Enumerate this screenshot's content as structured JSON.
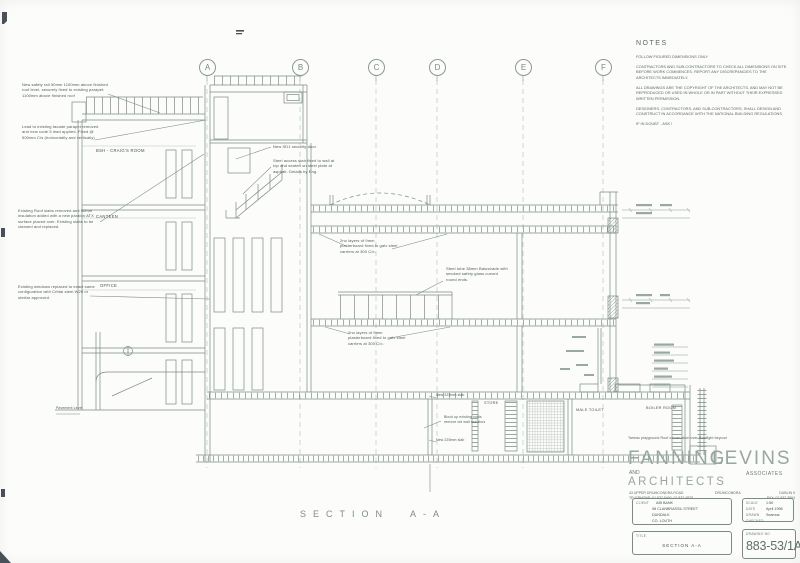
{
  "sheet": {
    "background": "#fcfcfa",
    "line_color": "#7b8b85",
    "text_color": "#4e5e58",
    "accent_light": "#98a7a1"
  },
  "grid": {
    "a": "A",
    "b": "B",
    "c": "C",
    "d": "D",
    "e": "E",
    "f": "F"
  },
  "notes": {
    "heading": "NOTES",
    "para1": "FOLLOW FIGURED DIMENSIONS ONLY",
    "para2": "CONTRACTORS AND SUB-CONTRACTORS TO CHECK ALL DIMENSIONS ON SITE BEFORE WORK COMMENCES. REPORT ANY DISCREPANCIES TO THE ARCHITECTS IMMEDIATELY.",
    "para3": "ALL DRAWINGS ARE THE COPYRIGHT OF THE ARCHITECTS, AND MAY NOT BE REPRODUCED OR USED IN WHOLE OR IN PART WITHOUT THEIR EXPRESSED WRITTEN PERMISSION.",
    "para4": "DESIGNERS, CONTRACTORS, AND SUB-CONTRACTORS, SHALL DESIGN AND CONSTRUCT IN ACCORDANCE WITH THE NATIONAL BUILDING REGULATIONS",
    "para5": "IF IN DOUBT - ASK !"
  },
  "annotations": {
    "safety_rail": "New safety rail 50mm 1100mm above finished roof level, securely fixed to existing parapet. 1100mm above finished roof",
    "lead_parapet": "Lead to existing facade parapet removed and new code 5 lead applied. Fixed @ 500mm C/s (horizontally and vertically)",
    "roof_slabs": "Existing Roof slabs removed and 50mm insulation added with a new paralon ATX surface placed over. Existing slabs to be cleaned and replaced.",
    "windows_replaced": "Existing windows replaced to exact same configuration with Crittal steel W20 or similar approved.",
    "security_door": "New SD1 security door",
    "access_stair": "Steel access stair fixed to wall at top and seated on steel plate at asphalt. Details by Eng.",
    "plasterboard_upper": "2no layers of 9mm plasterboard fixed to galv steel carriers at 300 C/c.",
    "balustrade_note": "Steel tube 38mm Balustrade with smoked safety glass curved round ends.",
    "plasterboard_lower": "2no layers of 9mm plasterboard fixed to galv steel carriers at 300 C/c.",
    "slab_upper": "New 225mm slab",
    "block_up": "Block up existing voids remove old wall radiators",
    "slab_lower": "New 225mm slab",
    "playground_note": "Tarmac playground    Roof construction over    Rooflight beyond",
    "pavement": "Pavement Level"
  },
  "rooms": {
    "room1": "BSH - CRAIG'S ROOM",
    "room2": "CANTEEN",
    "room3": "OFFICE",
    "store": "STORE",
    "male_toilet": "MALE TOILET",
    "boiler": "BOILER ROOM"
  },
  "section_title": "SECTION A-A",
  "titleblock": {
    "firm1": "FANNING",
    "firm2": "LEVINS",
    "and": "AND",
    "associates": "ASSOCIATES",
    "architects": "ARCHITECTS",
    "address": "43 UPPER DRUMCONDRA ROAD",
    "phone": "TELEPHONE: 01 837 5400, 01 837 4875",
    "area": "DRUMCONDRA",
    "city": "DUBLIN 9",
    "fax": "FAX: 01 837 3804",
    "client_label": "CLIENT",
    "client_name": "AIB BANK",
    "client_addr1": "98 CLANBRASSIL STREET",
    "client_addr2": "DUNDALK",
    "client_addr3": "CO. LOUTH",
    "scale_label": "SCALE",
    "scale": "1:50",
    "date_label": "DATE",
    "date": "April 1998",
    "drawn_label": "DRAWN",
    "drawn": "Seamus",
    "checked_label": "CHECKED",
    "checked": "",
    "title_label": "TITLE",
    "title": "SECTION A-A",
    "drawing_no_label": "DRAWING NO",
    "drawing_no": "883-53/1A"
  }
}
